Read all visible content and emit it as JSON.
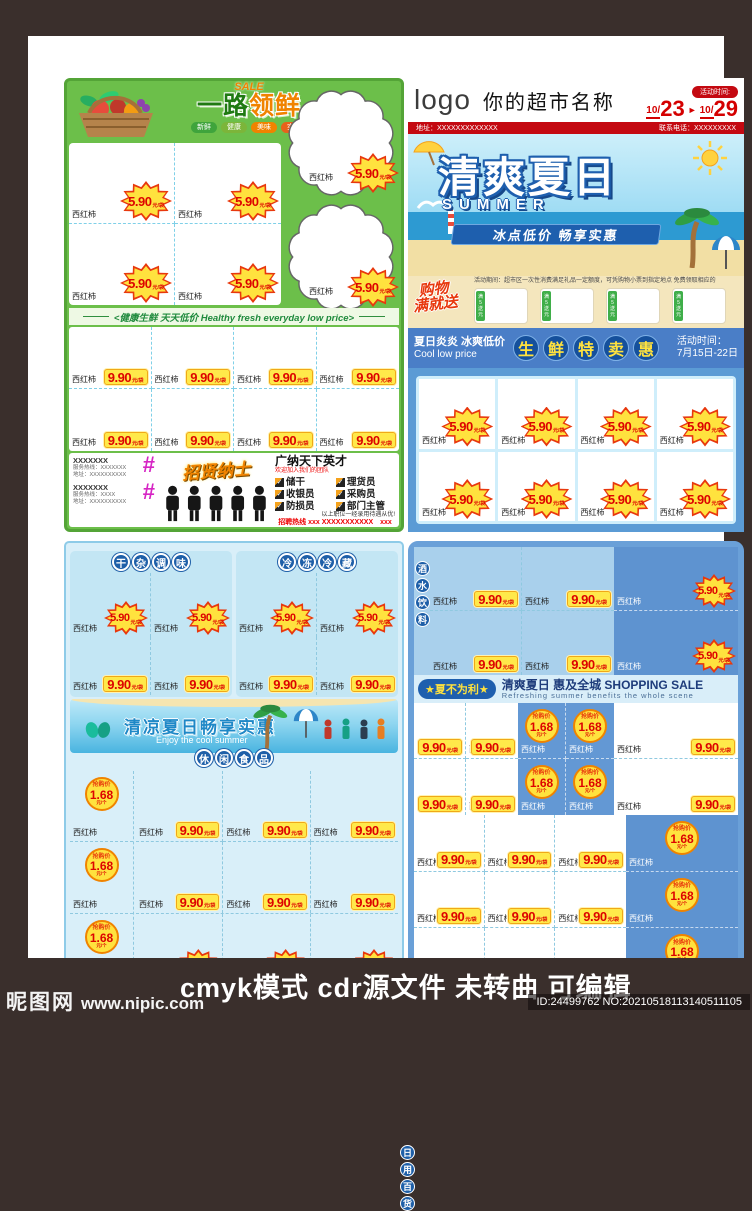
{
  "tags": {
    "product": "西红柿",
    "star_price": "5.90",
    "rect_price": "9.90",
    "flash_price": "1.68",
    "unit_bag": "元/袋",
    "unit_each": "元/个",
    "flash_label": "抢购价"
  },
  "counts": {
    "tl_panel_cells": 4,
    "tl_cloud_cells": 2,
    "tl_grid_cells": 8,
    "tr_grid_cells": 8,
    "tr_gift_boxes": 4,
    "bl_sec_star_cells": 2,
    "bl_sec_rect_cells": 2,
    "bl_flash_cells": 3,
    "bl_rect_cells": 6,
    "bl_star_cells": 3,
    "br1_rect_cells": 4,
    "br1_star_cells": 2,
    "br3_left_cells": 4,
    "br3_flash_cells": 4,
    "br3_right_cells": 2,
    "br4_rect_cells": 9,
    "br4_flash_cells": 3
  },
  "top_left": {
    "sale_script": "SALE",
    "title_part1": "一路",
    "title_part2": "领鲜",
    "badges": [
      "新鲜",
      "健康",
      "美味",
      "实惠"
    ],
    "band_text": "<健康生鲜 天天低价 Healthy fresh everyday low price>",
    "recruit": {
      "block1_name": "XXXXXXX",
      "block1_line1": "服务热线：XXXXXXX",
      "block1_line2": "地址：XXXXXXXXXX",
      "block2_name": "XXXXXXX",
      "block2_line1": "服务热线：XXXX",
      "block2_line2": "地址：XXXXXXXXXX",
      "hash_glyph": "#",
      "title": "招贤纳士",
      "headline": "广纳天下英才",
      "subline": "欢迎加入我们的团队",
      "positions": [
        "储干",
        "理货员",
        "收银员",
        "采购员",
        "防损员",
        "部门主管"
      ],
      "check_glyph": "✓",
      "note": "以上职位一经录用待遇从优!",
      "hotline": "招聘热线 xxx XXXXXXXXXXX　xxx XXXXXXXXXXX"
    }
  },
  "top_right": {
    "logo": "logo",
    "store_name": "你的超市名称",
    "time_label": "活动时间:",
    "date_from_month": "10/",
    "date_from_day": "23",
    "arrow": "►",
    "date_to_month": "10/",
    "date_to_day": "29",
    "address": "地址：XXXXXXXXXXXXX",
    "phone": "联系电话：XXXXXXXXX",
    "banner": {
      "title": "清爽夏日",
      "subtitle": "SUMMER",
      "ribbon": "冰点低价 畅享实惠"
    },
    "gift": {
      "script_line1": "购物",
      "script_line2": "满就送",
      "note": "活动期间：超市区一次性消费满足礼品一定额度，可凭购物小票到指定地点 免费领取相应的",
      "tag": "满5送元"
    },
    "band": {
      "left_cn": "夏日炎炎 冰爽低价",
      "left_en": "Cool low price",
      "circles": "生鲜特卖惠",
      "right_label": "活动时间：",
      "right_date": "7月15日-22日"
    }
  },
  "bottom_left": {
    "section1_badge": "干杂调味",
    "section2_badge": "冷冻冷藏",
    "beach_cn": "清凉夏日畅享实惠",
    "beach_en": "Enjoy the cool summer",
    "snack_badge": "休闲食品"
  },
  "bottom_right": {
    "drinks_badge": "酒水饮料",
    "daily_badge": "日用百货",
    "band_pill": "★夏不为利★",
    "band_cn": "清爽夏日 惠及全城 SHOPPING SALE",
    "band_en": "Refreshing summer benefits the whole scene"
  },
  "footer": {
    "watermark_site": "昵图网",
    "watermark_url": "www.nipic.com",
    "main_text": "cmyk模式 cdr源文件 未转曲 可编辑",
    "id_text": "ID:24499762 NO:20210518113140511105"
  }
}
